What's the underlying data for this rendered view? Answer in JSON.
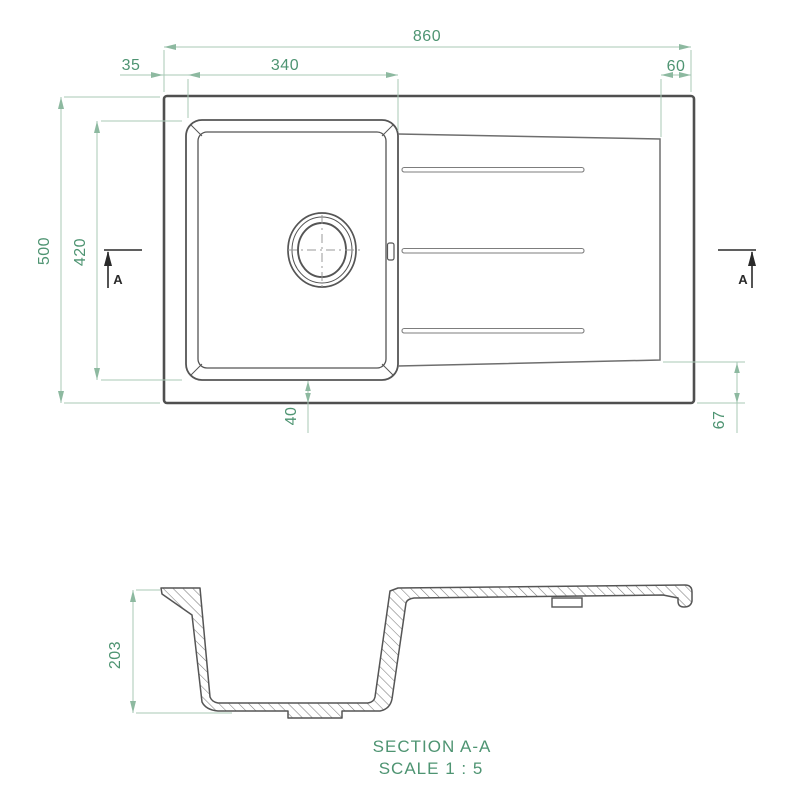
{
  "drawing": {
    "subject": "Kitchen sink with single bowl and drainer - dimensioned technical drawing",
    "units": "mm"
  },
  "colors": {
    "dimension_text": "#4e9472",
    "dimension_line": "#a8c8b6",
    "outline_dark": "#4f4f4f",
    "outline_mid": "#6e6e6e",
    "marker_dark": "#2a2a2a"
  },
  "top_view": {
    "dimensions": {
      "overall_width": "860",
      "bowl_left_offset": "35",
      "bowl_width": "340",
      "drainer_right_margin": "60",
      "overall_depth": "500",
      "bowl_depth": "420",
      "bowl_bottom_offset": "40",
      "drainer_bottom_offset": "67"
    },
    "section_markers": {
      "left_label": "A",
      "right_label": "A"
    }
  },
  "section_view": {
    "dimensions": {
      "bowl_height": "203"
    },
    "caption_title": "SECTION A-A",
    "caption_scale": "SCALE 1 : 5"
  }
}
